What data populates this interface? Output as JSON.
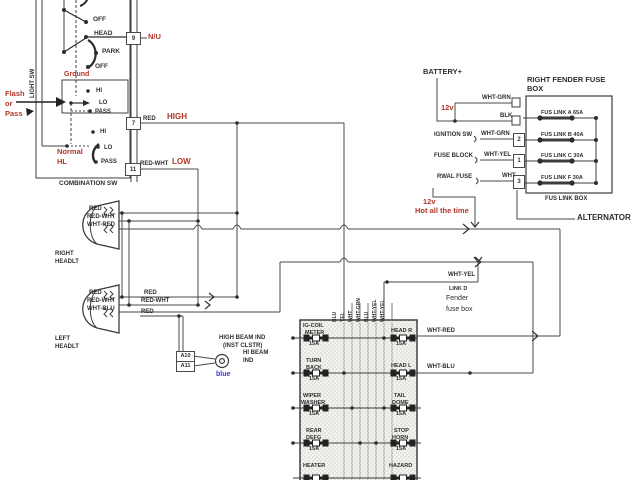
{
  "colors": {
    "wire": "#404040",
    "accent_red": "#b23528",
    "accent_blue": "#3a3ad0"
  },
  "combo": {
    "title": "COMBINATION SW",
    "light_sw": "LIGHT SW",
    "ground": "Ground",
    "flash": [
      "Flash",
      "or",
      "Pass"
    ],
    "normal": [
      "Normal",
      "HL"
    ],
    "pos": [
      "OFF",
      "HEAD",
      "PARK",
      "OFF"
    ],
    "dim_up": [
      "HI",
      "LO",
      "PASS"
    ],
    "dim_lo": [
      "HI",
      "LO",
      "PASS"
    ],
    "terms": [
      "9",
      "7",
      "11"
    ],
    "nu": "N/U",
    "wire_high": "RED",
    "high": "HIGH",
    "wire_low": "RED-WHT",
    "low": "LOW"
  },
  "rffb": {
    "battery": "BATTERY+",
    "v12": "12v",
    "title": [
      "RIGHT FENDER FUSE",
      "BOX"
    ],
    "in_wires": [
      "WHT-GRN",
      "BLK",
      "WHT-GRN",
      "WHT-YEL",
      "WHT"
    ],
    "sources": [
      "IGNITION SW",
      "FUSE BLOCK",
      "RWAL FUSE"
    ],
    "terms": [
      "2",
      "1",
      "3"
    ],
    "links": [
      "FUS LINK A 65A",
      "FUS LINK B 40A",
      "FUS LINK C 30A",
      "FUS LINK F 30A"
    ],
    "caption": "FUS LINK BOX"
  },
  "feed": {
    "v12": "12v",
    "hot": "Hot all the time",
    "alternator": "ALTERNATOR"
  },
  "rh": {
    "name": [
      "RIGHT",
      "HEADLT"
    ],
    "wires": [
      "RED",
      "RED-WHT",
      "WHT-RED"
    ]
  },
  "lh": {
    "name": [
      "LEFT",
      "HEADLT"
    ],
    "wires": [
      "RED",
      "RED-WHT",
      "WHT-BLU"
    ]
  },
  "mid": {
    "wires": [
      "RED",
      "RED-WHT",
      "RED"
    ]
  },
  "hbi": {
    "title": [
      "HIGH BEAM IND",
      "(INST CLSTR)"
    ],
    "terms": [
      "A10",
      "A11"
    ],
    "ind": [
      "HI BEAM",
      "IND"
    ],
    "blue": "blue"
  },
  "ffb": {
    "whtyel": "WHT-YEL",
    "link": "LINK D",
    "name": [
      "Fender",
      "fuse box"
    ],
    "whtred": "WHT-RED",
    "whtblu": "WHT-BLU",
    "cols": [
      "BLU",
      "YEL",
      "WHT",
      "WHT-GRN",
      "BLU",
      "WHT-YEL",
      "WHT-YEL"
    ],
    "fuses_left": [
      [
        "IG-COIL",
        "METER",
        "15A"
      ],
      [
        "TURN",
        "BACK",
        "15A"
      ],
      [
        "WIPER",
        "WASHER",
        "15A"
      ],
      [
        "REAR",
        "DEFG",
        "15A"
      ],
      [
        "HEATER",
        "",
        ""
      ]
    ],
    "fuses_right": [
      [
        "HEAD R",
        "",
        "15A"
      ],
      [
        "HEAD L",
        "",
        "15A"
      ],
      [
        "TAIL",
        "DOME",
        "15A"
      ],
      [
        "STOP",
        "HORN",
        "15A"
      ],
      [
        "HAZARD",
        "",
        ""
      ]
    ]
  }
}
